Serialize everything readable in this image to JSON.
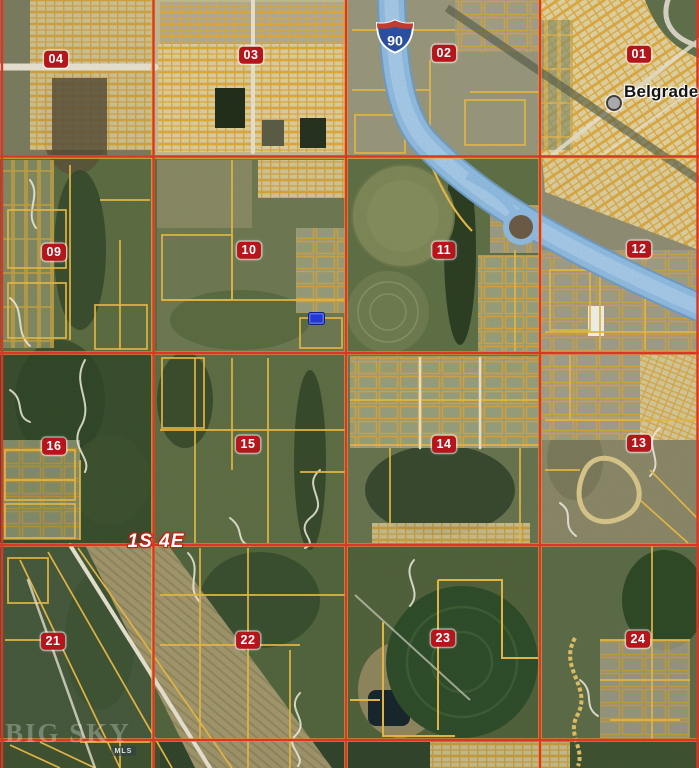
{
  "map": {
    "town": {
      "name": "Belgrade"
    },
    "township_range_label": "1S 4E",
    "highway": {
      "shield_number": "90",
      "type": "interstate"
    },
    "sections": [
      "04",
      "03",
      "02",
      "01",
      "09",
      "10",
      "11",
      "12",
      "16",
      "15",
      "14",
      "13",
      "21",
      "22",
      "23",
      "24"
    ],
    "watermark": {
      "brand": "BIG SKY",
      "badge": "MLS"
    },
    "colors": {
      "section_grid_red": "#e63222",
      "parcel_line_yellow": "#e7b844",
      "badge_red": "#b4161b",
      "water_highway_blue": "#8fbbe2",
      "property_marker_blue": "#2338d2"
    }
  }
}
